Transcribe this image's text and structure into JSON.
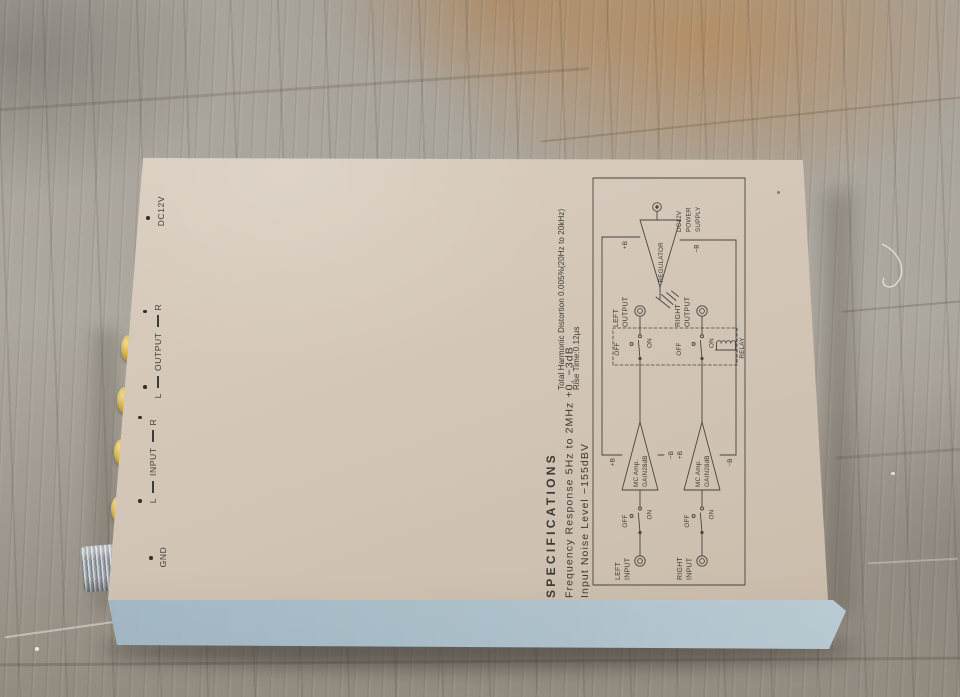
{
  "panel": {
    "gnd": "GND",
    "input": {
      "l": "L",
      "word": "INPUT",
      "r": "R"
    },
    "output": {
      "l": "L",
      "word": "OUTPUT",
      "r": "R"
    },
    "dc12v": "DC12V"
  },
  "specs": {
    "title": "SPECIFICATIONS",
    "frequency": "Frequency Response 5Hz to 2MHz +0, −3dB",
    "noise": "Input Noise Level −155dBV",
    "thd": "Total Harmonic Distortion 0.005%(20Hz to 20kHz)",
    "rise": "Rise Time:0.12μs"
  },
  "sch": {
    "left_input_1": "LEFT",
    "left_input_2": "INPUT",
    "right_input_1": "RIGHT",
    "right_input_2": "INPUT",
    "left_output_1": "LEFT",
    "left_output_2": "OUTPUT",
    "right_output_1": "RIGHT",
    "right_output_2": "OUTPUT",
    "off": "OFF",
    "on": "ON",
    "amp_1": "MC Amp.",
    "amp_2": "GAIN28dB",
    "plus_b": "+B",
    "minus_b": "−B",
    "regulator": "REGULATOR",
    "relay": "RELAY",
    "power_1": "DC12V",
    "power_2": "POWER",
    "power_3": "SUPPLY"
  },
  "colors": {
    "chassis_top": "#d5c8b9",
    "chassis_front": "#b6c9d3",
    "connector_gold": "#cba23e",
    "print_ink": "#474540",
    "wood": "#a8a39b"
  }
}
